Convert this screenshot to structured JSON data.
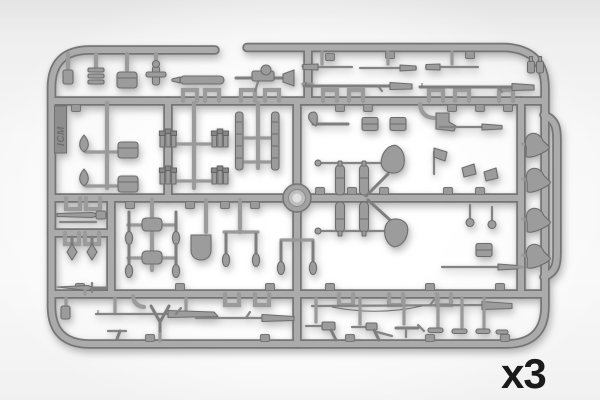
{
  "photo": {
    "subject": "Injection-molded gray plastic model-kit sprue with small-scale military accessory parts photographed on a light background",
    "quantity_label": "x3",
    "logo_text": "ICM"
  },
  "visible_part_types": [
    "long-rifles",
    "carbines",
    "machine-gun-with-drum-magazine",
    "pistols",
    "stick-grenade-clusters",
    "ammo-magazines",
    "ammo-pouches",
    "crates",
    "teardrop-canteens",
    "water-bottle-shells",
    "large-shovels",
    "square-shovel",
    "entrenching-tool-paddles",
    "pickaxe",
    "hatchet",
    "bayonet-and-scabbard",
    "dagger",
    "diamond-tipped-pins",
    "bell-shaped-horns",
    "boots",
    "bipod",
    "cleaning-rods",
    "small-bottles"
  ],
  "colors": {
    "bg-edge": "#e4e4e4",
    "bg-center": "#ffffff",
    "plastic": "#ababab",
    "plastic-dark": "#757575",
    "part-fill": "#9c9c9c",
    "part-edge": "#6d6d6d",
    "label": "#1a1a1a"
  }
}
